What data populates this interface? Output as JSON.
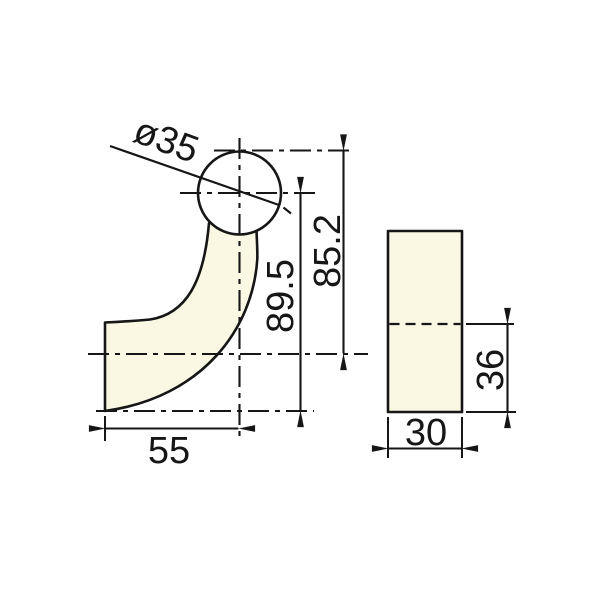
{
  "colors": {
    "background": "#ffffff",
    "line": "#161616",
    "part_fill": "#faf8e2"
  },
  "drawing": {
    "side_view": {
      "diameter_label": "ø35",
      "height_center_label": "89.5",
      "height_overall_label": "85.2",
      "base_width_label": "55"
    },
    "front_view": {
      "lower_height_label": "36",
      "width_label": "30"
    }
  }
}
